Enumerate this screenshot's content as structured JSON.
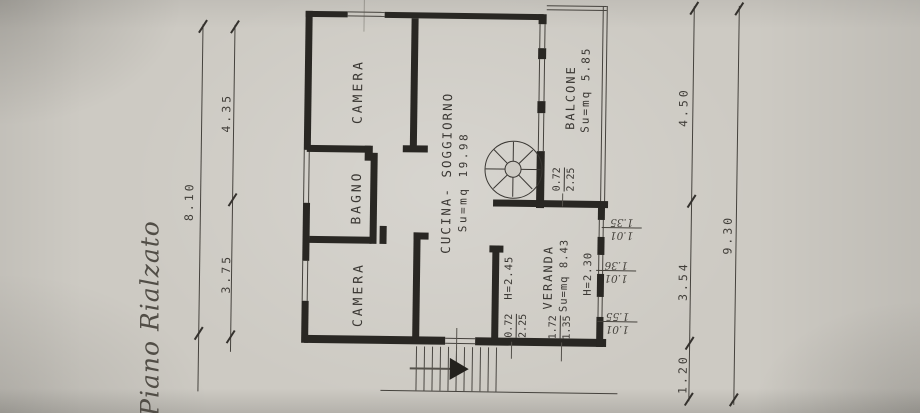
{
  "document": {
    "type": "scanned floor plan photo",
    "title": "Piano Rialzato"
  },
  "rooms": {
    "camera_top": {
      "label": "CAMERA"
    },
    "bagno": {
      "label": "BAGNO"
    },
    "camera_bottom": {
      "label": "CAMERA"
    },
    "cucina_soggiorno": {
      "label": "CUCINA- SOGGIORNO",
      "area": "Su=mq 19.98"
    },
    "balcone": {
      "label": "BALCONE",
      "area": "Su=mq 5.85"
    },
    "veranda": {
      "label": "VERANDA",
      "area": "Su=mq 8.43",
      "height": "H=2.30"
    },
    "hall": {
      "height": "H=2.45"
    }
  },
  "dims": {
    "left_total": "8.10",
    "left_upper": "4.35",
    "left_lower": "3.75",
    "right_upper": "4.50",
    "right_middle": "3.54",
    "right_lower": "1.20",
    "right_total": "9.30"
  },
  "door_dims": {
    "balcony_door": {
      "num": "0.72",
      "den": "2.25"
    },
    "entry_door": {
      "num": "0.72",
      "den": "2.25"
    },
    "veranda_win": {
      "num": "1.72",
      "den": "1.35"
    }
  },
  "window_dims": [
    {
      "num": "1.35",
      "den": "1.01"
    },
    {
      "num": "1.36",
      "den": "1.01"
    },
    {
      "num": "1.55",
      "den": "1.01"
    }
  ],
  "colors": {
    "paper": "#cdcac3",
    "ink": "#292723",
    "text": "#3a3733"
  }
}
